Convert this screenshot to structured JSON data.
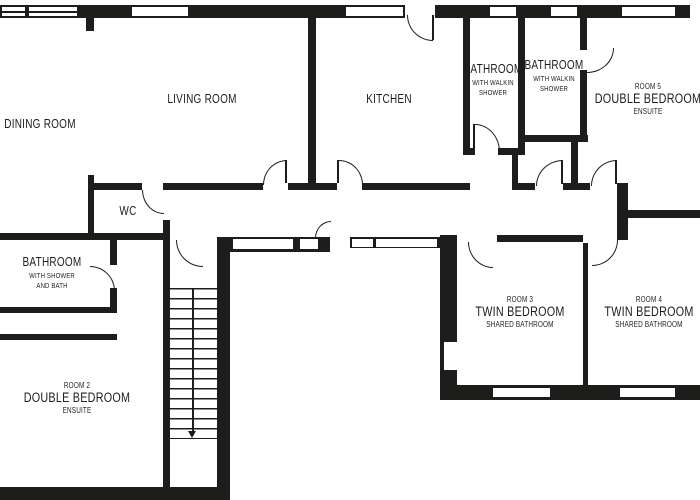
{
  "plan": {
    "colors": {
      "wall": "#1d1d1b",
      "background": "#ffffff"
    },
    "rooms": {
      "dining": {
        "name": "DINING ROOM"
      },
      "living": {
        "name": "LIVING ROOM"
      },
      "kitchen": {
        "name": "KITCHEN"
      },
      "bathroom_walkin_left": {
        "name": "BATHROOM",
        "detail1": "WITH WALKIN",
        "detail2": "SHOWER"
      },
      "bathroom_walkin_right": {
        "name": "BATHROOM",
        "detail1": "WITH WALKIN",
        "detail2": "SHOWER"
      },
      "room5": {
        "number": "ROOM 5",
        "name": "DOUBLE BEDROOM",
        "detail": "ENSUITE"
      },
      "wc": {
        "name": "WC"
      },
      "bathroom_shower_bath": {
        "name": "BATHROOM",
        "detail1": "WITH SHOWER",
        "detail2": "AND BATH"
      },
      "room2": {
        "number": "ROOM 2",
        "name": "DOUBLE BEDROOM",
        "detail": "ENSUITE"
      },
      "room3": {
        "number": "ROOM 3",
        "name": "TWIN BEDROOM",
        "detail": "SHARED BATHROOM"
      },
      "room4": {
        "number": "ROOM 4",
        "name": "TWIN BEDROOM",
        "detail": "SHARED BATHROOM"
      }
    }
  }
}
